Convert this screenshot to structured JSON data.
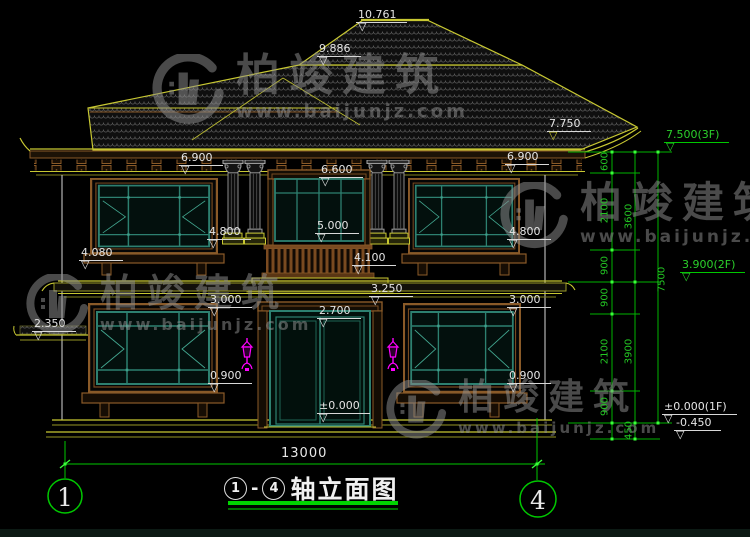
{
  "drawing": {
    "title": {
      "axis_start": "1",
      "dash": "-",
      "axis_end": "4",
      "name": "轴立面图"
    },
    "axis_bubbles": {
      "left": "1",
      "right": "4"
    },
    "total_width_dim": "13000",
    "elevation_marks": {
      "m10_761": "10.761",
      "m9_886": "9.886",
      "m7_750": "7.750",
      "m6_900_l": "6.900",
      "m6_900_r": "6.900",
      "m6_600": "6.600",
      "m5_000": "5.000",
      "m4_800_l": "4.800",
      "m4_800_r": "4.800",
      "m4_100": "4.100",
      "m4_080": "4.080",
      "m3_250": "3.250",
      "m3_000_l": "3.000",
      "m3_000_r": "3.000",
      "m2_700": "2.700",
      "m2_350": "2.350",
      "m0_900_l": "0.900",
      "m0_900_r": "0.900",
      "m0_000": "±0.000"
    },
    "floor_marks": {
      "f3": "7.500(3F)",
      "f2": "3.900(2F)",
      "f1": "±0.000(1F)",
      "ground": "-0.450"
    },
    "chain": {
      "col1": [
        "600",
        "2100",
        "900",
        "900",
        "2100",
        "900"
      ],
      "col2": [
        "3600",
        "3900",
        "450"
      ],
      "col3": [
        "7500"
      ]
    }
  },
  "watermark": {
    "brand": "柏竣建筑",
    "url": "www.baijunjz.com"
  },
  "colors": {
    "dim_green": "#00c800",
    "bright_green": "#3aff3a",
    "cad_yellow": "#c8c832",
    "trim_brown": "#8a5a28",
    "frame_teal": "#2d8070",
    "lamp_magenta": "#ff00ff",
    "text_white": "#e6e6e6",
    "watermark_gray": "#8f8f8f"
  }
}
